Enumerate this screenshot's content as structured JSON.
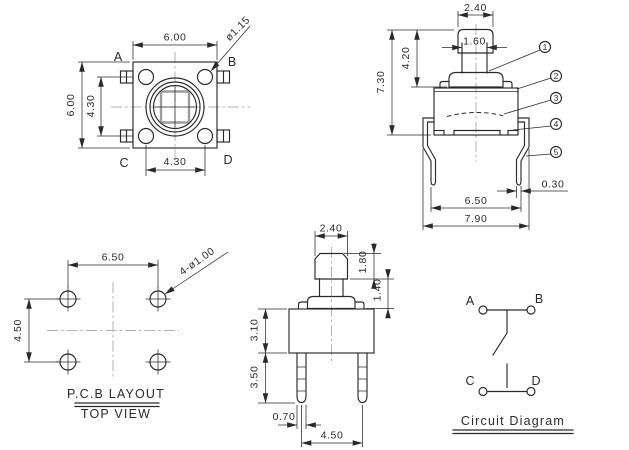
{
  "colors": {
    "line": "#2a2a2a",
    "centerline": "#b3b3b3",
    "background": "#ffffff",
    "button_square": "#9c9c9c"
  },
  "top_view": {
    "pin_labels": {
      "a": "A",
      "b": "B",
      "c": "C",
      "d": "D"
    },
    "dim_width": "6.00",
    "dim_height": "6.00",
    "dim_pin_pitch_v": "4.30",
    "dim_pin_pitch_h": "4.30",
    "dim_button": "ø1.15"
  },
  "side_view": {
    "dim_cap_width": "2.40",
    "dim_stem_width": "1.60",
    "dim_stem_height": "4.20",
    "dim_total_height": "7.30",
    "dim_lead_thickness": "0.30",
    "dim_lead_span": "6.50",
    "dim_overall_width": "7.90",
    "callouts": [
      "1",
      "2",
      "3",
      "4",
      "5"
    ]
  },
  "pcb_view": {
    "dim_hole_pitch_h": "6.50",
    "dim_hole_pitch_v": "4.50",
    "dim_holes": "4-ø1.00",
    "title": "P.C.B  LAYOUT",
    "subtitle": "TOP  VIEW"
  },
  "front_view": {
    "dim_cap_width": "2.40",
    "dim_cap_height": "1.80",
    "dim_collar_height": "1.40",
    "dim_body_height": "3.10",
    "dim_lead_length": "3.50",
    "dim_lead_width": "0.70",
    "dim_lead_pitch": "4.50"
  },
  "circuit": {
    "terminals": {
      "a": "A",
      "b": "B",
      "c": "C",
      "d": "D"
    },
    "title": "Circuit  Diagram"
  }
}
